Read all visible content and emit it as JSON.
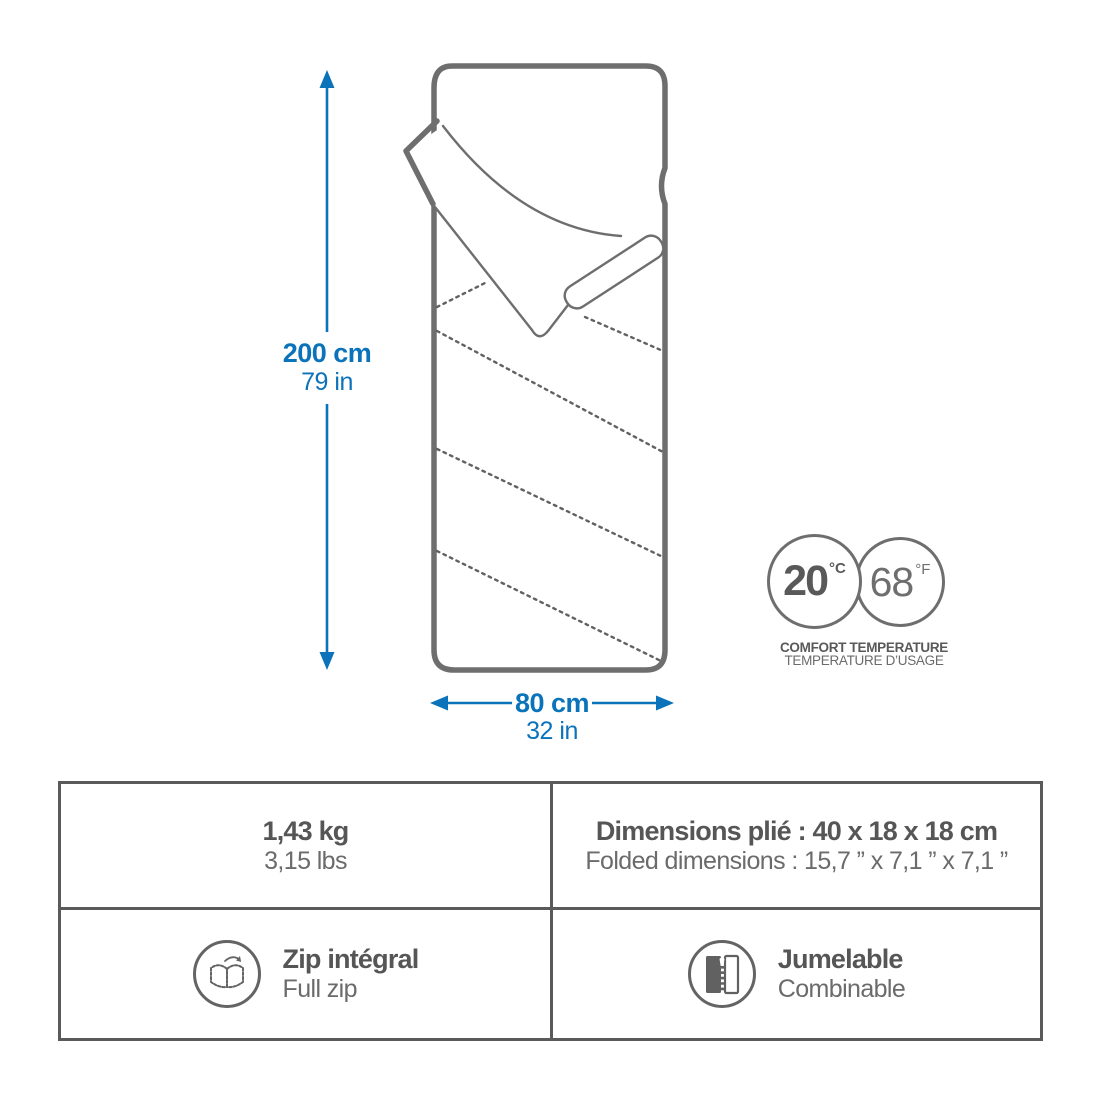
{
  "diagram": {
    "length": {
      "metric": "200 cm",
      "imperial": "79 in"
    },
    "width": {
      "metric": "80 cm",
      "imperial": "32 in"
    },
    "comfort_temperature": {
      "celsius_value": "20",
      "celsius_unit": "°C",
      "fahrenheit_value": "68",
      "fahrenheit_unit": "°F",
      "label_line1": "COMFORT TEMPERATURE",
      "label_line2": "TEMPERATURE D’USAGE"
    }
  },
  "spec_table": {
    "weight": {
      "metric": "1,43 kg",
      "imperial": "3,15 lbs"
    },
    "folded_dimensions": {
      "fr": "Dimensions plié : 40 x 18 x 18 cm",
      "en": "Folded dimensions : 15,7 ” x 7,1 ” x 7,1 ”"
    },
    "full_zip": {
      "fr": "Zip intégral",
      "en": "Full zip",
      "icon": "open-bag-full-zip-icon"
    },
    "combinable": {
      "fr": "Jumelable",
      "en": "Combinable",
      "icon": "zipper-combine-icon"
    }
  },
  "colors": {
    "accent_blue": "#0a73ba",
    "line_gray": "#6e6e6e",
    "text_dark": "#565656",
    "text_gray": "#6b6b6b"
  }
}
